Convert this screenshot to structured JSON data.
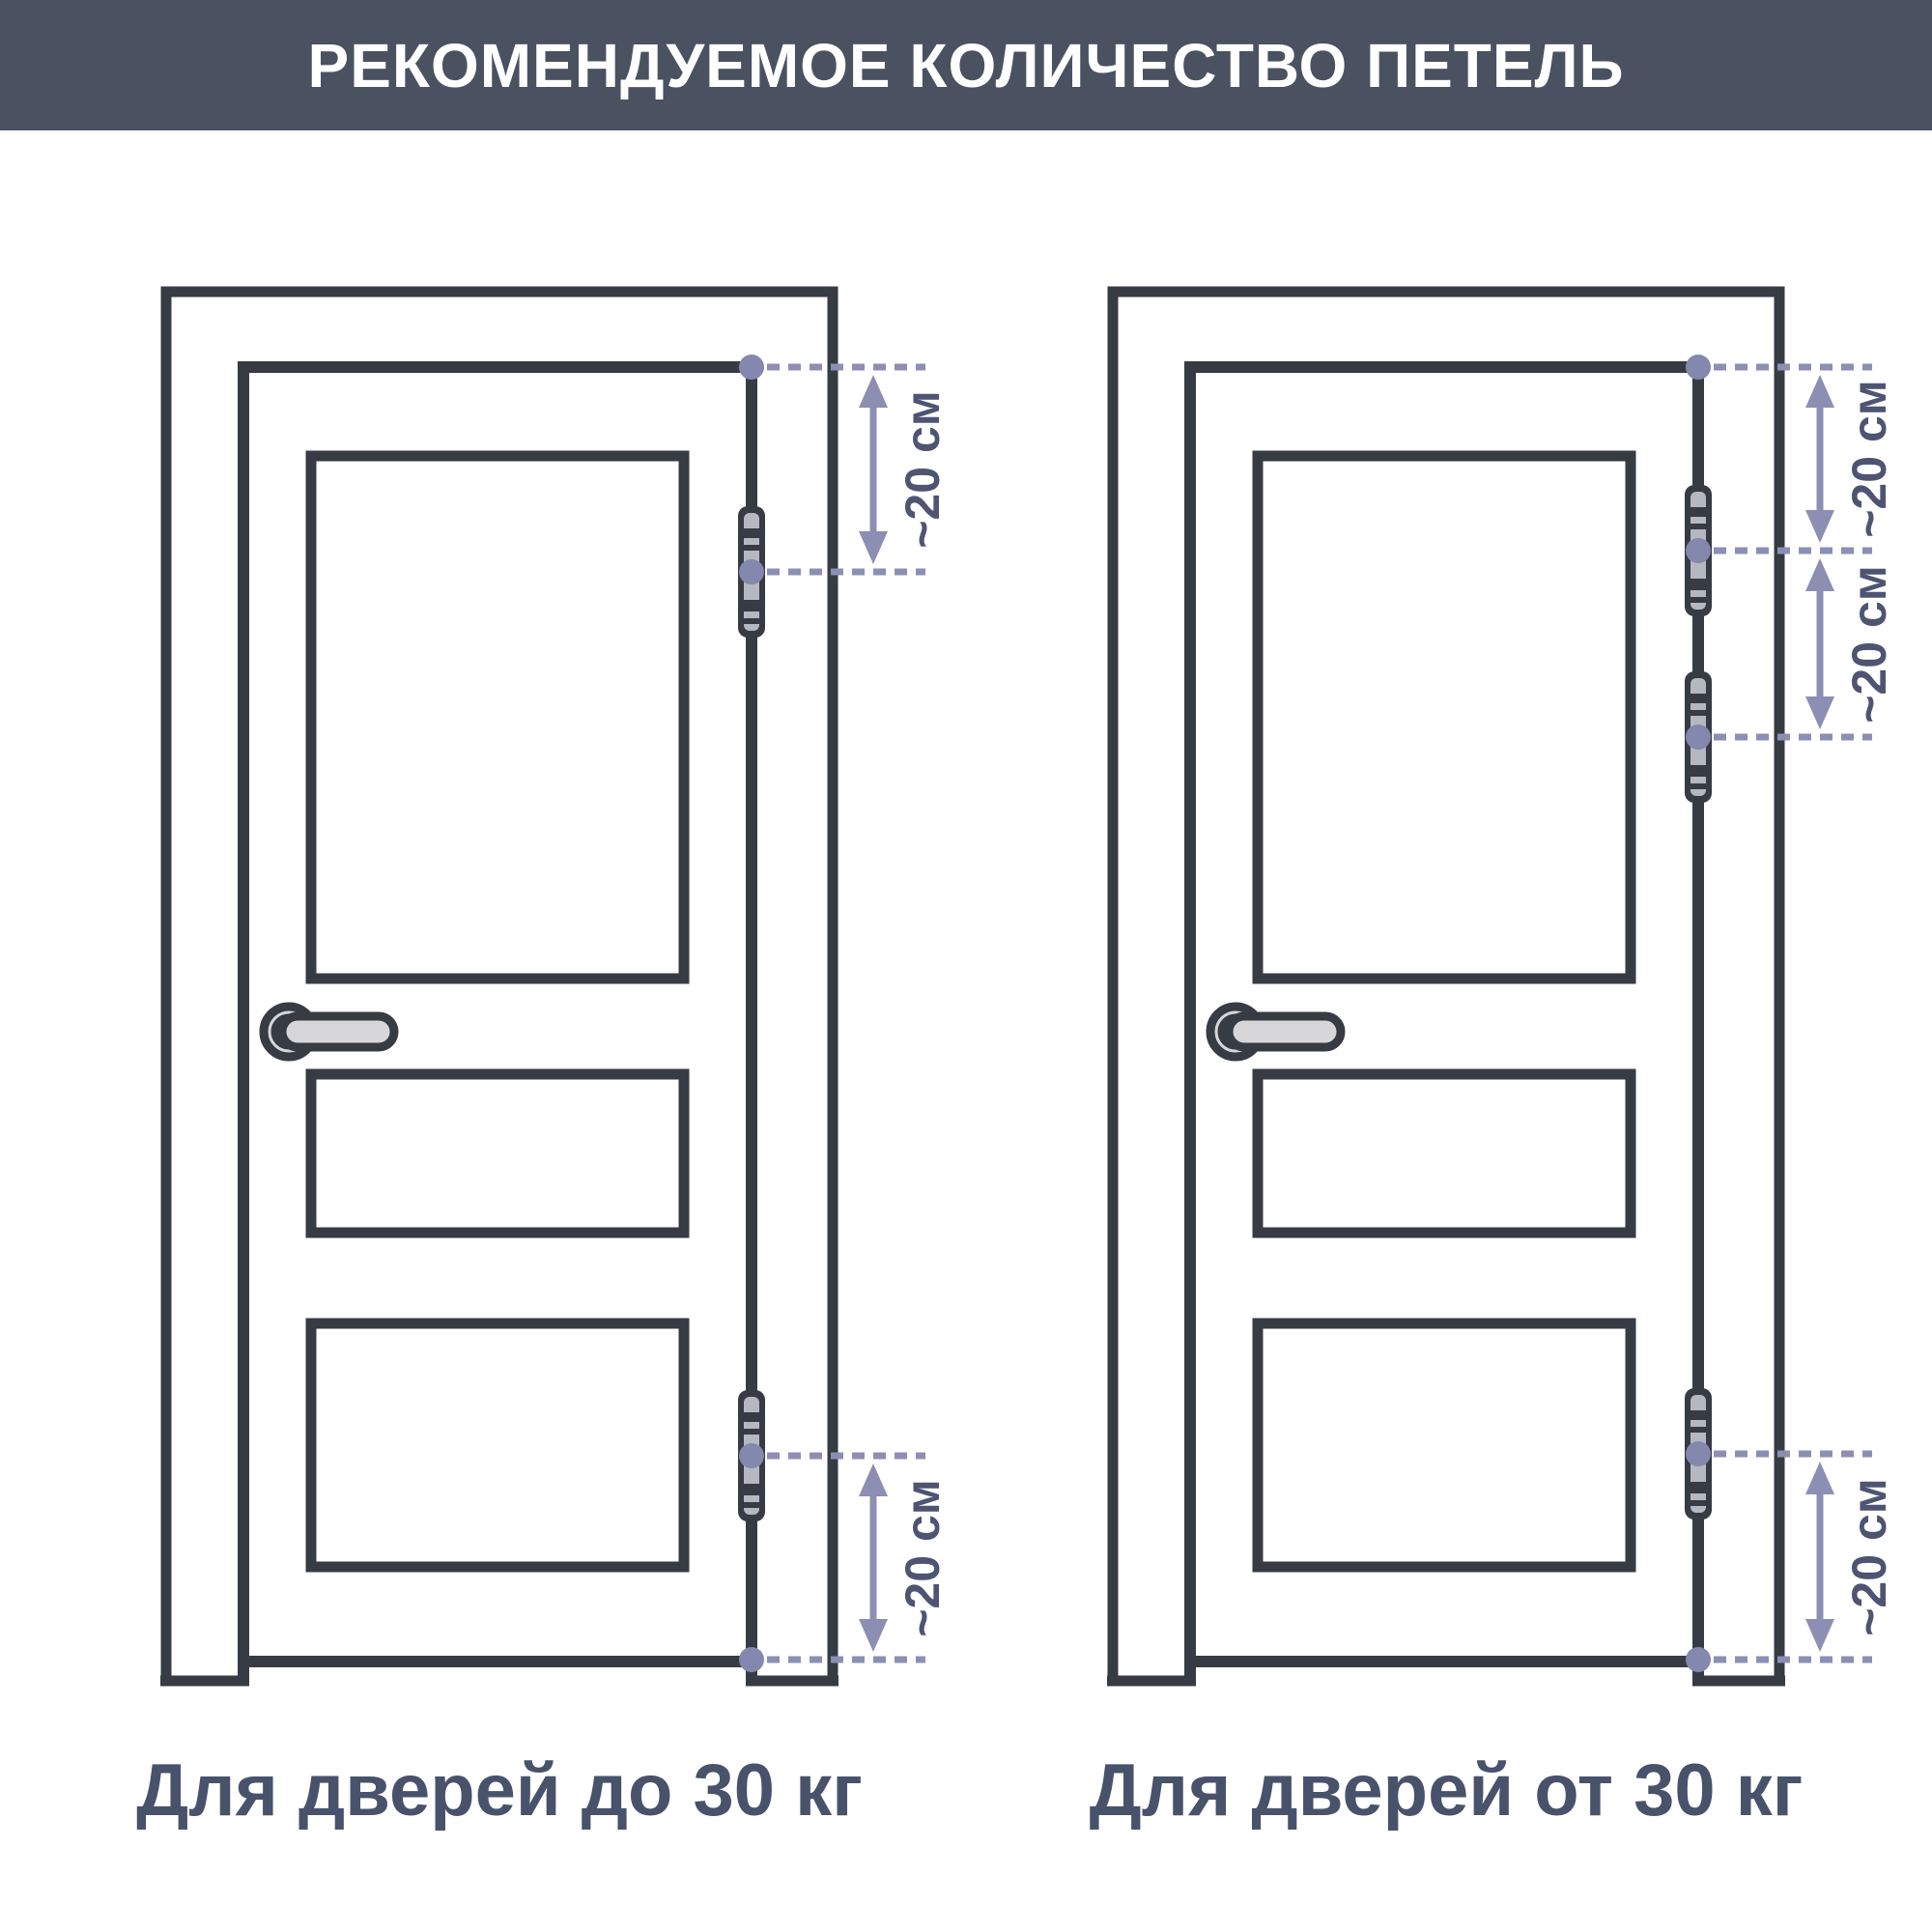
{
  "header": {
    "title": "РЕКОМЕНДУЕМОЕ КОЛИЧЕСТВО ПЕТЕЛЬ"
  },
  "doors": [
    {
      "id": "door-up-to-30kg",
      "label": "Для дверей до 30 кг",
      "hinge_count": 2,
      "dimension_labels": [
        "~20 см",
        "~20 см"
      ]
    },
    {
      "id": "door-over-30kg",
      "label": "Для дверей от 30 кг",
      "hinge_count": 3,
      "dimension_labels": [
        "~20 см",
        "~20 см",
        "~20 см"
      ]
    }
  ],
  "colors": {
    "background": "#FFFFFF",
    "header_bg": "#4A5161",
    "header_text": "#FFFFFF",
    "outline": "#373B44",
    "dimension_accent": "#8C8FB3",
    "dimension_dot": "#8487AE",
    "dimension_text": "#4E5472",
    "label_text": "#49526B",
    "hinge_fill": "#B5B7C1",
    "handle_fill": "#D7D7DA"
  }
}
